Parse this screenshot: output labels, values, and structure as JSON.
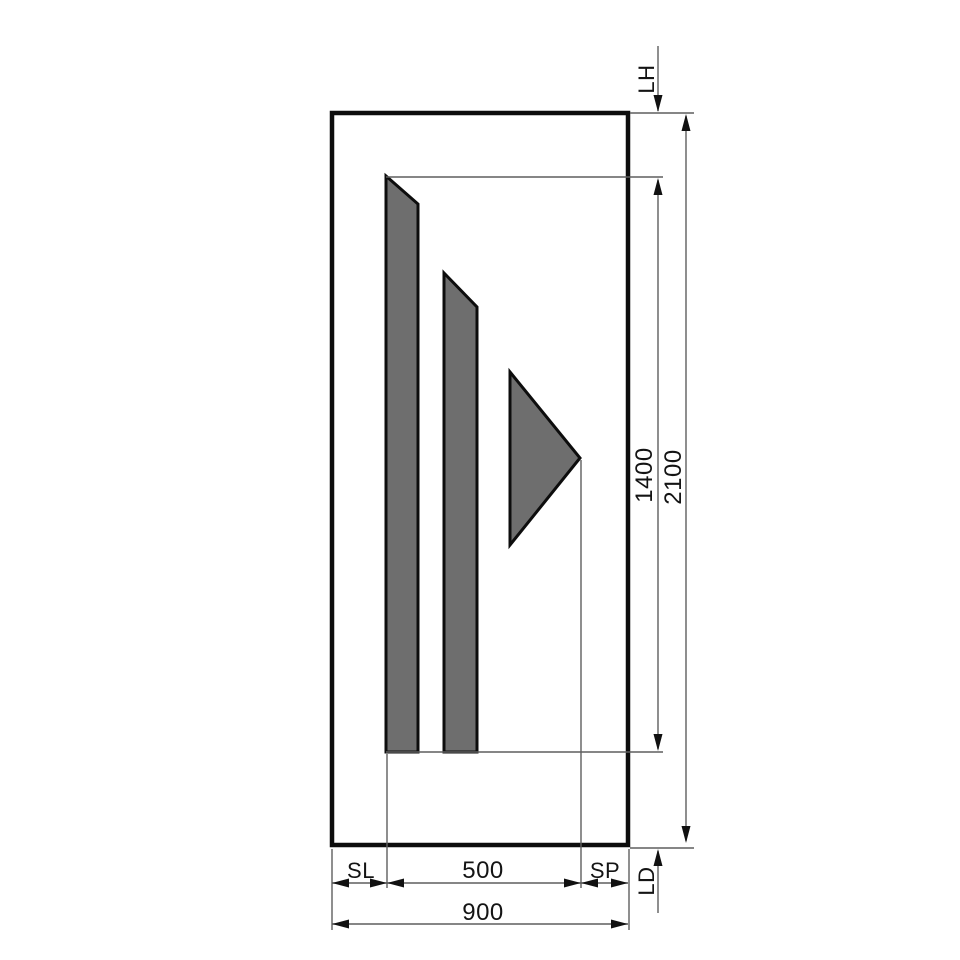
{
  "drawing": {
    "title": "Door panel dimension drawing",
    "labels": {
      "lintel_height": "LH",
      "sill_depth": "LD",
      "side_left": "SL",
      "side_right": "SP",
      "glass_width": "500",
      "total_width": "900",
      "glass_height": "1400",
      "total_height": "2100"
    },
    "colors": {
      "outline": "#0d0d0d",
      "dim_line": "#5f5f5f",
      "panel_fill": "#6e6e6e",
      "background": "#ffffff"
    }
  }
}
